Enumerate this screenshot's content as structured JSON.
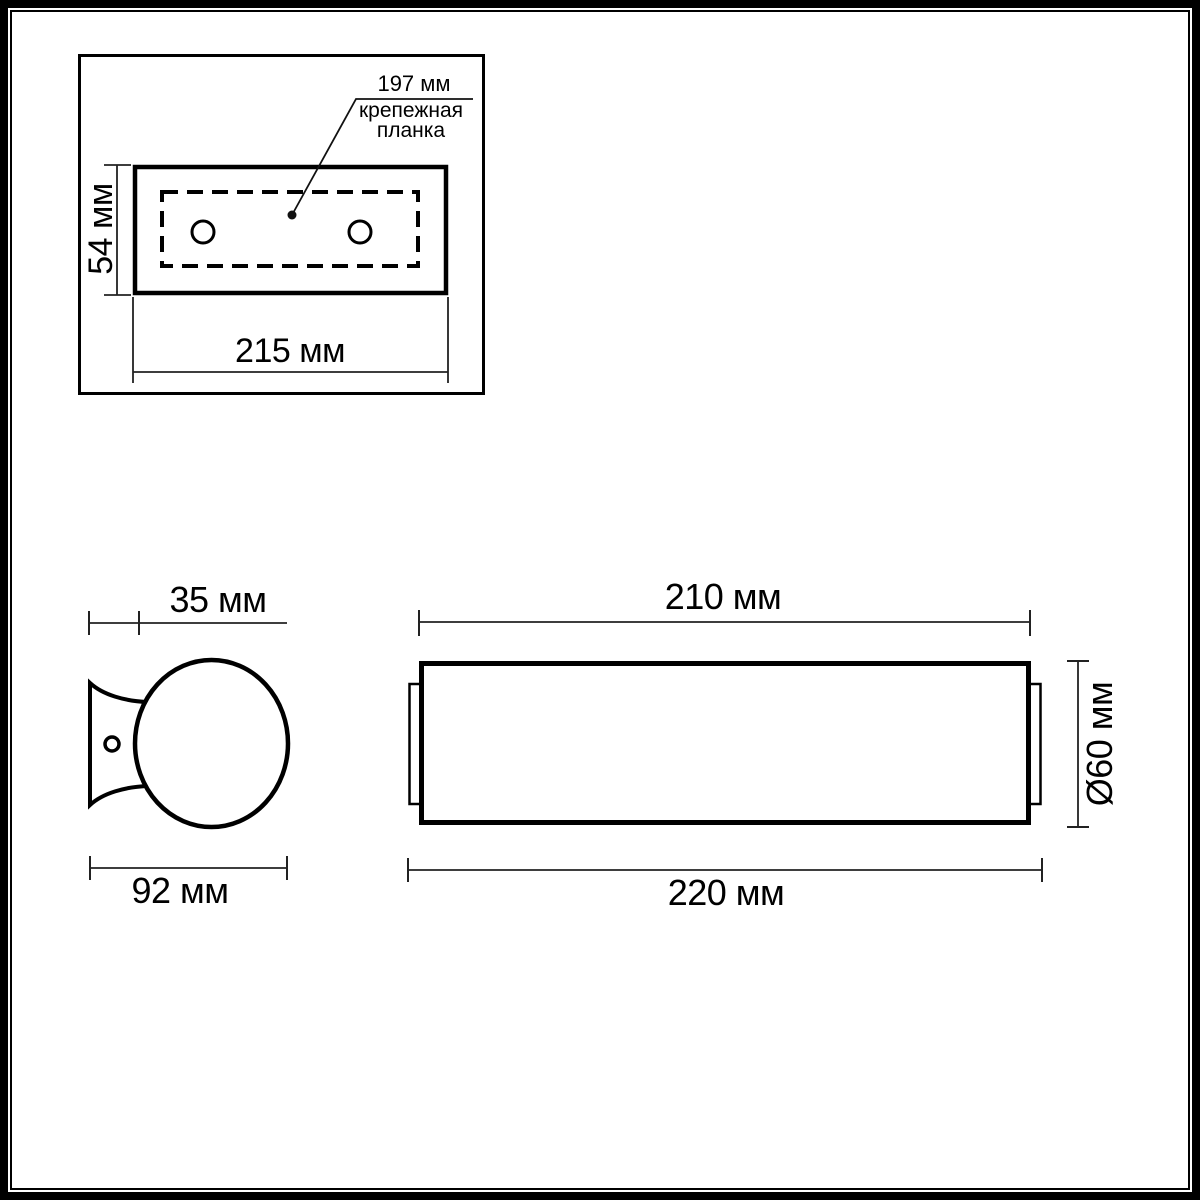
{
  "drawing": {
    "title_semantic": "wall-lamp-dimension-drawing",
    "colors": {
      "ink": "#000000",
      "dim_line": "#222222",
      "background": "#ffffff"
    },
    "top_view": {
      "plate_length_label": "215 мм",
      "plate_height_label": "54 мм",
      "leader_value_label": "197 мм",
      "leader_name_line1": "крепежная",
      "leader_name_line2": "планка"
    },
    "side_view": {
      "bracket_depth_label": "35 мм",
      "total_depth_label": "92 мм"
    },
    "front_view": {
      "glass_length_label": "210 мм",
      "total_length_label": "220 мм",
      "diameter_label": "Ø60 мм"
    }
  }
}
